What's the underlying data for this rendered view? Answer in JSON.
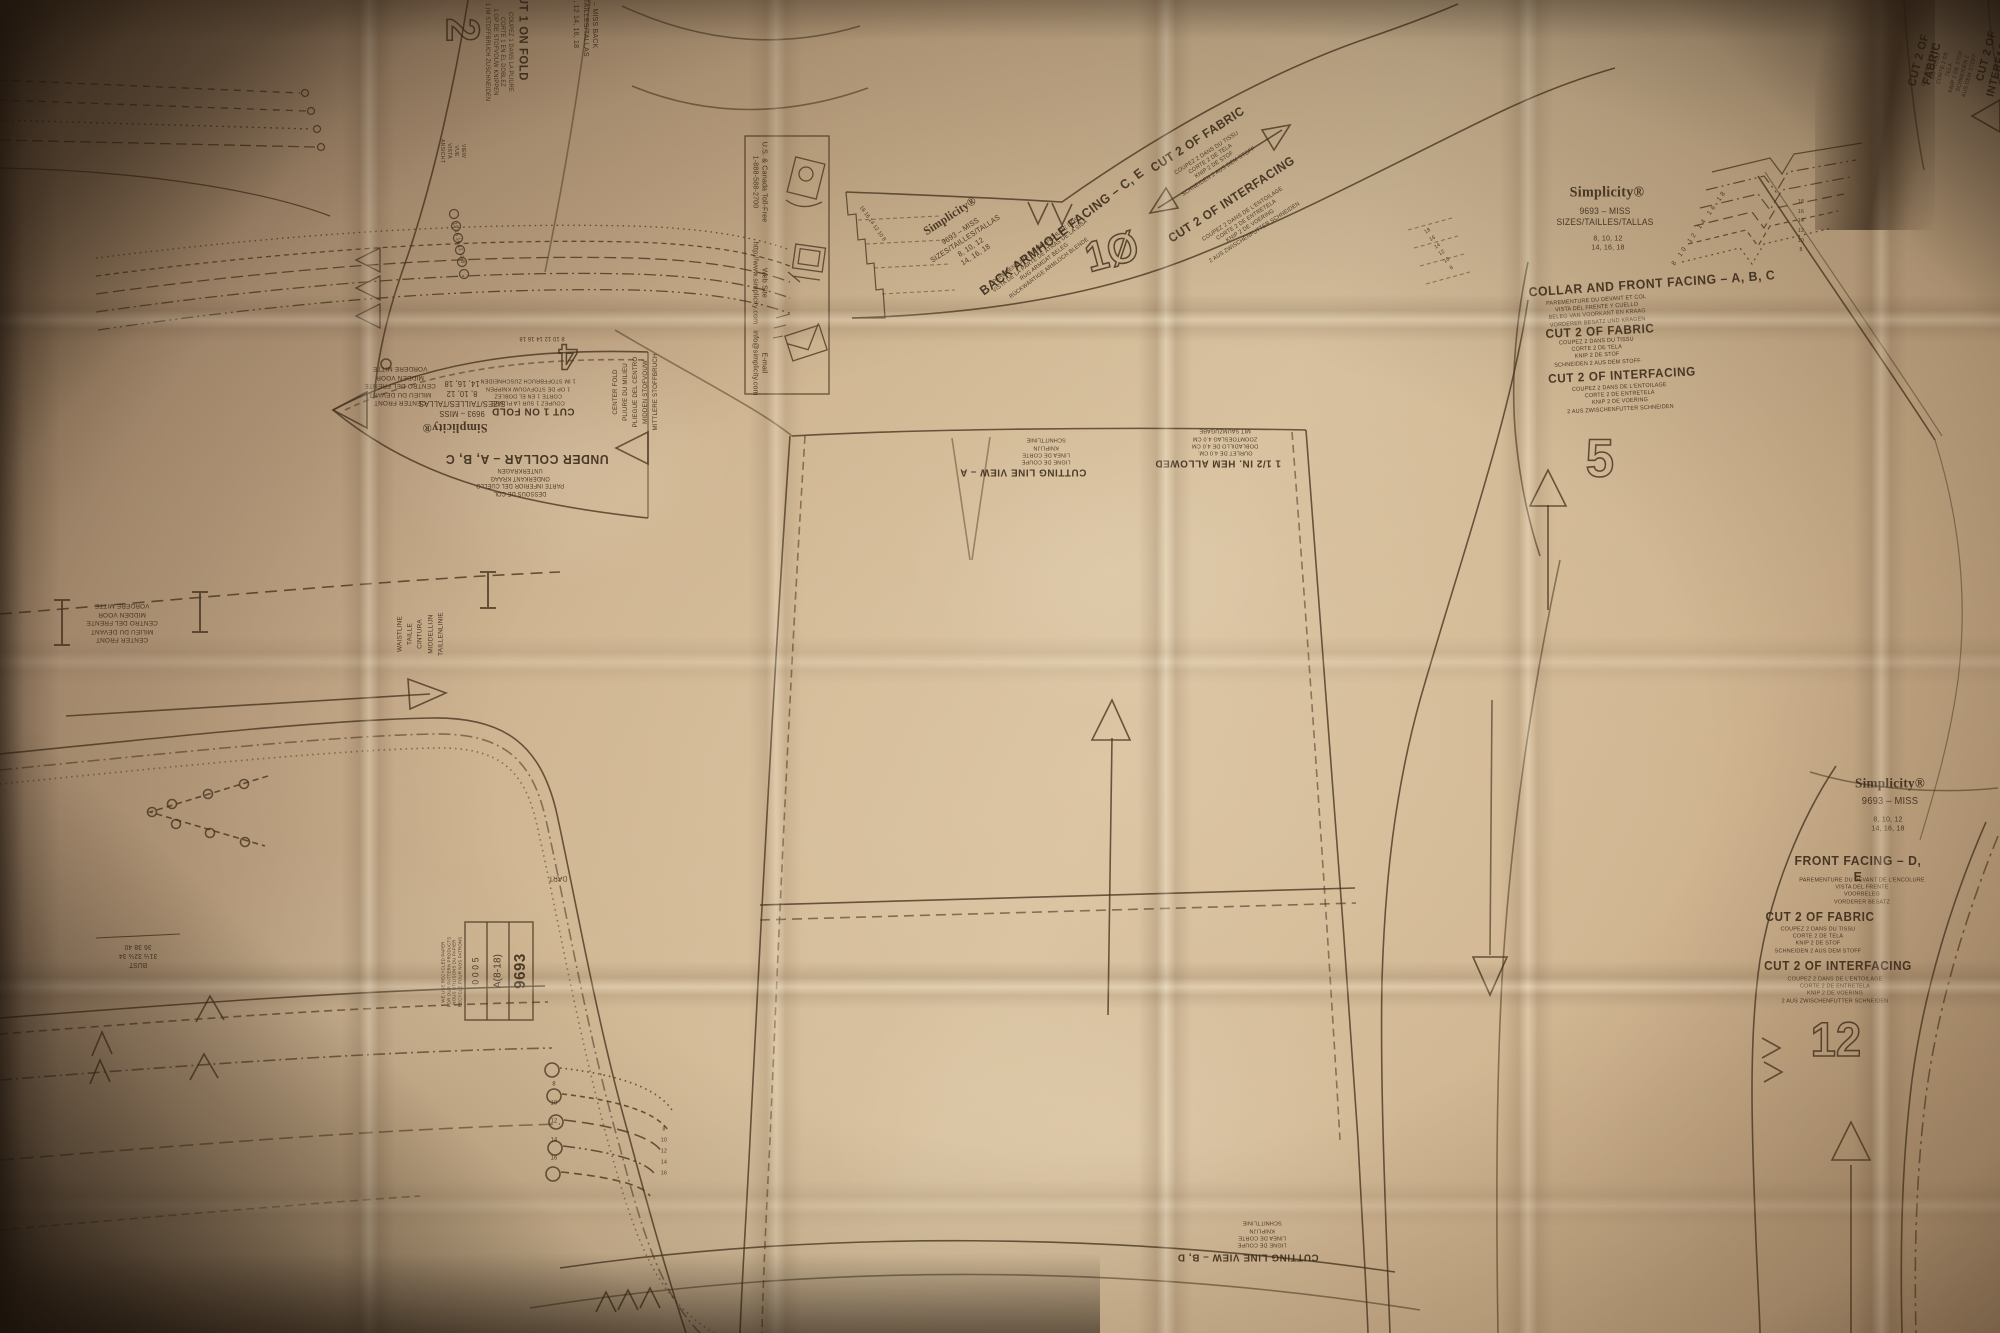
{
  "photo": {
    "subject": "Simplicity 9693 sewing pattern tissue sheet",
    "brand": "Simplicity",
    "pattern_number": "9693",
    "size_range": "A(8-18)",
    "colors": {
      "paper_light": "#d9c3a1",
      "paper_mid": "#c9ae8a",
      "paper_dark": "#8a7054",
      "corner_shadow": "#2e2114",
      "ink": "#3f2f20"
    }
  },
  "icons": [
    {
      "name": "telephone-icon",
      "meaning": "U.S. & Canada toll-free phone"
    },
    {
      "name": "computer-icon",
      "meaning": "web site"
    },
    {
      "name": "envelope-icon",
      "meaning": "e-mail"
    }
  ],
  "labels": [
    {
      "name": "piece2-number",
      "text": "2",
      "x": 462,
      "y": 30,
      "rot": 90,
      "size": 46,
      "hollow": true
    },
    {
      "name": "piece2-cut1-onfold",
      "text": "CUT 1 ON FOLD",
      "x": 523,
      "y": 34,
      "rot": 90,
      "size": 12,
      "bold": true
    },
    {
      "name": "piece2-cut1-onfold-sub",
      "text": "COUPEZ 1 DANS LA PLIURE\nCORTE 1 EN EL DOBLEZ\n1 OP DE STOFVOUW KNIPPEN\n1 IM STOFFBRUCH ZUSCHNEIDEN",
      "x": 498,
      "y": 52,
      "rot": 90,
      "size": 6
    },
    {
      "name": "piece2-info-block",
      "text": "9693 – MISS   BACK\nSIZES/TAILLES/TALLAS\n8, 10, 12   14, 16, 18",
      "x": 586,
      "y": 16,
      "rot": 90,
      "size": 7.5
    },
    {
      "name": "piece2-views",
      "text": "VIEW\nVUE\nVISTA\nANSICHT",
      "x": 452,
      "y": 151,
      "rot": 90,
      "size": 5.5
    },
    {
      "name": "infobox-phone-label",
      "text": "U.S. & Canada Toll-Free\n1-888-588-2700",
      "x": 760,
      "y": 182,
      "rot": 90,
      "size": 7.5
    },
    {
      "name": "infobox-web-label",
      "text": "Web Site\nhttp://www.simplicity.com",
      "x": 760,
      "y": 283,
      "rot": 90,
      "size": 7.5
    },
    {
      "name": "infobox-email-label",
      "text": "E-mail\ninfo@simplicity.com",
      "x": 760,
      "y": 363,
      "rot": 90,
      "size": 7.5
    },
    {
      "name": "collar-sizes-column",
      "text": "18 16 14 12 10 8",
      "x": 458,
      "y": 243,
      "rot": 78,
      "size": 5.5
    },
    {
      "name": "undercollar-title",
      "text": "UNDER COLLAR – A, B, C",
      "x": 527,
      "y": 459,
      "rot": 180,
      "size": 13,
      "bold": true
    },
    {
      "name": "undercollar-title-sub",
      "text": "DESSOUS DE COL\nPARTE INFERIOR DEL CUELLO\nONDERKANT KRAAG\nUNTERKRAGEN",
      "x": 520,
      "y": 481,
      "rot": 180,
      "size": 6
    },
    {
      "name": "undercollar-brand-logo",
      "text": "Simplicity®",
      "x": 455,
      "y": 428,
      "rot": 180,
      "size": 13,
      "brand": true
    },
    {
      "name": "undercollar-brand-info",
      "text": "9693 – MISS\nSIZES/TAILLES/TALLAS\n8, 10, 12\n14, 16, 18",
      "x": 462,
      "y": 398,
      "rot": 180,
      "size": 8
    },
    {
      "name": "undercollar-cut1-onfold",
      "text": "CUT 1 ON FOLD",
      "x": 533,
      "y": 411,
      "rot": 180,
      "size": 10.5,
      "bold": true
    },
    {
      "name": "undercollar-cut1-onfold-sub",
      "text": "COUPEZ 1 SUR LA PLIURE\nCORTE 1 EN EL DOBLEZ\n1 OP DE STOFVOUW KNIPPEN\n1 IM STOFFBRUCH ZUSCHNEIDEN",
      "x": 528,
      "y": 391,
      "rot": 180,
      "size": 5.8
    },
    {
      "name": "undercollar-centerfront",
      "text": "CENTER FRONT\nMILIEU DU DEVANT\nCENTRO DEL FRENTE\nMIDDEN VOOR\nVORDERE MITTE",
      "x": 400,
      "y": 385,
      "rot": 180,
      "size": 6.8
    },
    {
      "name": "undercollar-centerfold",
      "text": "CENTER FOLD\nPLIURE DU MILIEU\nPLIEGUE DEL CENTRO\nMIDDEN STOFVOUW\nMITTLERE STOFFBRUCH",
      "x": 636,
      "y": 392,
      "rot": -90,
      "size": 6.5,
      "lh": 1.55
    },
    {
      "name": "undercollar-number",
      "text": "4",
      "x": 568,
      "y": 357,
      "rot": 180,
      "size": 36,
      "hollow": true
    },
    {
      "name": "undercollar-sizes-cluster",
      "text": "8 10 12 14 16 18",
      "x": 542,
      "y": 337,
      "rot": 180,
      "size": 6
    },
    {
      "name": "armfacing-brand-logo",
      "text": "Simplicity®",
      "x": 950,
      "y": 216,
      "rot": -33,
      "size": 12,
      "brand": true
    },
    {
      "name": "armfacing-brand-info",
      "text": "9693 – MISS\nSIZES/TAILLES/TALLAS\n8, 10, 12\n14, 16, 18",
      "x": 968,
      "y": 243,
      "rot": -33,
      "size": 7.5
    },
    {
      "name": "armfacing-title",
      "text": "BACK ARMHOLE FACING – C, E",
      "x": 1062,
      "y": 232,
      "rot": -37,
      "size": 13,
      "bold": true
    },
    {
      "name": "armfacing-title-sub",
      "text": "PAREMENTURE D'EMMANCHURE DOS\nVISTA DE LA PARTE DE ATRAS DE LA SISA\nRUG ARMGAT BELEG\nRÜCKWÄRTIGE ARMLOCH BLENDE",
      "x": 1043,
      "y": 260,
      "rot": -37,
      "size": 5.8
    },
    {
      "name": "armfacing-number",
      "text": "1Ø",
      "x": 1112,
      "y": 252,
      "rot": -15,
      "size": 42,
      "hollow": true
    },
    {
      "name": "armfacing-cut2-fabric",
      "text": "CUT 2 OF FABRIC",
      "x": 1198,
      "y": 140,
      "rot": -33,
      "size": 12.5,
      "bold": true
    },
    {
      "name": "armfacing-cut2-fabric-sub",
      "text": "COUPEZ 2 DANS DU TISSU\nCORTE 2 DE TELA\nKNIP 2 DE STOF\nSCHNEIDEN 2 AUS DEM STOFF",
      "x": 1213,
      "y": 163,
      "rot": -33,
      "size": 5.8
    },
    {
      "name": "armfacing-cut2-interfacing",
      "text": "CUT 2 OF INTERFACING",
      "x": 1232,
      "y": 200,
      "rot": -33,
      "size": 12.5,
      "bold": true
    },
    {
      "name": "armfacing-cut2-interfacing-sub",
      "text": "COUPEZ 2 DANS DE L'ENTOILAGE\nCORTE 2 DE ENTRETELA\nKNIP 2 DE VOERING\n2 AUS ZWISCHENFUTTER SCHNEIDEN",
      "x": 1249,
      "y": 224,
      "rot": -33,
      "size": 5.8
    },
    {
      "name": "armfacing-sizes-left",
      "text": "18 16 14 12 10 8",
      "x": 872,
      "y": 224,
      "rot": 55,
      "size": 5.5
    },
    {
      "name": "armfacing-sizes-right",
      "text": "18\n16\n14\n12\n10\n8",
      "x": 1440,
      "y": 250,
      "rot": -33,
      "size": 5.5,
      "lh": 1.6
    },
    {
      "name": "trcorner-cut2-fabric",
      "text": "CUT 2 OF FABRIC",
      "x": 1926,
      "y": 62,
      "rot": -75,
      "size": 11.5,
      "bold": true
    },
    {
      "name": "trcorner-cut2-fabric-sub",
      "text": "COUPEZ 2 DANS DU TISSU\nCORTE 2 DE TELA\nKNIP 2 DE STOF\nSCHNEIDEN 2 AUS DEM STOFF",
      "x": 1950,
      "y": 70,
      "rot": -75,
      "size": 5.6
    },
    {
      "name": "trcorner-cut2-interfacing",
      "text": "CUT 2 OF INTERFACING",
      "x": 1994,
      "y": 58,
      "rot": -75,
      "size": 11,
      "bold": true
    },
    {
      "name": "facing5-brand-logo",
      "text": "Simplicity®",
      "x": 1607,
      "y": 193,
      "rot": 0,
      "size": 15,
      "brand": true
    },
    {
      "name": "facing5-brand-info",
      "text": "9693 – MISS\nSIZES/TAILLES/TALLAS",
      "x": 1605,
      "y": 217,
      "rot": 0,
      "size": 9
    },
    {
      "name": "facing5-brand-sizes",
      "text": "8, 10, 12\n14, 16, 18",
      "x": 1608,
      "y": 243,
      "rot": 0,
      "size": 7.5
    },
    {
      "name": "facing5-sizes-arc",
      "text": "8 10 12 14 16 18",
      "x": 1700,
      "y": 228,
      "rot": -55,
      "size": 6.5,
      "ls": 3
    },
    {
      "name": "facing5-title",
      "text": "COLLAR AND FRONT FACING – A, B, C",
      "x": 1652,
      "y": 284,
      "rot": -4,
      "size": 13,
      "bold": true
    },
    {
      "name": "facing5-title-sub",
      "text": "PAREMENTURE DU DEVANT ET COL\nVISTA DEL FRENTE Y CUELLO\nBELEG VAN VOORKANT EN KRAAG\nVORDERER BESATZ UND KRAGEN",
      "x": 1597,
      "y": 312,
      "rot": -4,
      "size": 5.8
    },
    {
      "name": "facing5-cut2-fabric",
      "text": "CUT 2 OF FABRIC",
      "x": 1600,
      "y": 332,
      "rot": -3,
      "size": 12.5,
      "bold": true
    },
    {
      "name": "facing5-cut2-fabric-sub",
      "text": "COUPEZ 2 DANS DU TISSU\nCORTE 2 DE TELA\nKNIP 2 DE STOF\nSCHNEIDEN 2 AUS DEM STOFF",
      "x": 1597,
      "y": 353,
      "rot": -3,
      "size": 5.8
    },
    {
      "name": "facing5-cut2-interfacing",
      "text": "CUT 2 OF INTERFACING",
      "x": 1622,
      "y": 376,
      "rot": -3,
      "size": 12.5,
      "bold": true
    },
    {
      "name": "facing5-cut2-interfacing-sub",
      "text": "COUPEZ 2 DANS DE L'ENTOILAGE\nCORTE 2 DE ENTRETELA\nKNIP 2 DE VOERING\n2 AUS ZWISCHENFUTTER SCHNEIDEN",
      "x": 1620,
      "y": 399,
      "rot": -3,
      "size": 5.8
    },
    {
      "name": "facing5-number",
      "text": "5",
      "x": 1600,
      "y": 459,
      "rot": 0,
      "size": 54,
      "hollow": true
    },
    {
      "name": "facing5-sizes-right",
      "text": "18\n16\n14\n12\n10\n8",
      "x": 1801,
      "y": 227,
      "rot": 0,
      "size": 5.5,
      "lh": 1.75
    },
    {
      "name": "facingDE-brand-logo",
      "text": "Simplicity®",
      "x": 1890,
      "y": 784,
      "rot": 0,
      "size": 14,
      "brand": true
    },
    {
      "name": "facingDE-brand-info",
      "text": "9693 – MISS",
      "x": 1890,
      "y": 802,
      "rot": 0,
      "size": 10
    },
    {
      "name": "facingDE-brand-sizes",
      "text": "8, 10, 12\n14, 16, 18",
      "x": 1888,
      "y": 824,
      "rot": 0,
      "size": 7.5
    },
    {
      "name": "facingDE-title",
      "text": "FRONT FACING – D, E",
      "x": 1858,
      "y": 869,
      "rot": 0,
      "size": 13,
      "bold": true
    },
    {
      "name": "facingDE-title-sub",
      "text": "PAREMENTURE DU DEVANT DE L'ENCOLURE\nVISTA DEL FRENTE\nVOORBELEG\nVORDERER BESATZ",
      "x": 1862,
      "y": 892,
      "rot": 0,
      "size": 5.8
    },
    {
      "name": "facingDE-cut2-fabric",
      "text": "CUT 2 OF FABRIC",
      "x": 1820,
      "y": 918,
      "rot": 0,
      "size": 12.5,
      "bold": true
    },
    {
      "name": "facingDE-cut2-fabric-sub",
      "text": "COUPEZ 2 DANS DU TISSU\nCORTE 2 DE TELA\nKNIP 2 DE STOF\nSCHNEIDEN 2 AUS DEM STOFF",
      "x": 1818,
      "y": 941,
      "rot": 0,
      "size": 5.8
    },
    {
      "name": "facingDE-cut2-interfacing",
      "text": "CUT 2 OF INTERFACING",
      "x": 1838,
      "y": 967,
      "rot": 0,
      "size": 12.5,
      "bold": true
    },
    {
      "name": "facingDE-cut2-interfacing-sub",
      "text": "COUPEZ 2 DANS DE L'ENTOILAGE\nCORTE 2 DE ENTRETELA\nKNIP 2 DE VOERING\n2 AUS ZWISCHENFUTTER SCHNEIDEN",
      "x": 1835,
      "y": 991,
      "rot": 0,
      "size": 5.8
    },
    {
      "name": "facingDE-number",
      "text": "12",
      "x": 1836,
      "y": 1041,
      "rot": 0,
      "size": 48,
      "hollow": true
    },
    {
      "name": "skirtA-cuttingline",
      "text": "CUTTING LINE VIEW – A",
      "x": 1023,
      "y": 472,
      "rot": 180,
      "size": 10.5,
      "bold": true
    },
    {
      "name": "skirtA-cuttingline-sub",
      "text": "LIGNE DE COUPE\nLINEA DE CORTE\nKNIPLIJN\nSCHNITTLINIE",
      "x": 1046,
      "y": 450,
      "rot": 180,
      "size": 5.8
    },
    {
      "name": "skirtA-hem-allowance",
      "text": "1 1/2 IN. HEM ALLOWED",
      "x": 1218,
      "y": 463,
      "rot": 180,
      "size": 10.5,
      "bold": true
    },
    {
      "name": "skirtA-hem-allowance-sub",
      "text": "OURLET DE 4.0 CM.\nDOBLADILLO DE 4.0 CM\nZOOMTOESLAG 4.0 CM\nMIT SAUMZUGABE",
      "x": 1225,
      "y": 441,
      "rot": 180,
      "size": 5.8
    },
    {
      "name": "skirtBD-cuttingline",
      "text": "CUTTING LINE VIEW – B, D",
      "x": 1248,
      "y": 1257,
      "rot": 180,
      "size": 10.5,
      "bold": true
    },
    {
      "name": "skirtBD-cuttingline-sub",
      "text": "LIGNE DE COUPE\nLINEA DE CORTE\nKNIPLIJN\nSCHNITTLINIE",
      "x": 1262,
      "y": 1233,
      "rot": 180,
      "size": 5.8
    },
    {
      "name": "leftpiece-centerfront",
      "text": "CENTER FRONT\nMILIEU DU DEVANT\nCENTRO DEL FRENTE\nMIDDEN VOOR\nVORDERE MITTE",
      "x": 122,
      "y": 622,
      "rot": 180,
      "size": 6.8
    },
    {
      "name": "leftpiece-waistline",
      "text": "WAISTLINE\nTAILLE\nCINTURA\nMIDDELLIJN\nTAILLENLINIE",
      "x": 421,
      "y": 634,
      "rot": -90,
      "size": 6.8,
      "lh": 1.5
    },
    {
      "name": "leftpiece-bust-table",
      "text": "BUST\n31½  32½  34\n36   38   40",
      "x": 138,
      "y": 955,
      "rot": 180,
      "size": 7
    },
    {
      "name": "leftpiece-dart-label",
      "text": "DART",
      "x": 558,
      "y": 877,
      "rot": 180,
      "size": 7
    },
    {
      "name": "leftpiece-fold-sizes-circles",
      "text": "8\n10\n12\n14\n16",
      "x": 554,
      "y": 1122,
      "rot": 0,
      "size": 6,
      "lh": 3.1
    },
    {
      "name": "leftpiece-fold-sizes-bend",
      "text": "8\n10\n12\n14\n16",
      "x": 664,
      "y": 1152,
      "rot": 0,
      "size": 5.5,
      "lh": 2.0
    },
    {
      "name": "pattern-number-box-number",
      "text": "9693",
      "x": 521,
      "y": 971,
      "rot": -90,
      "size": 16,
      "bold": true
    },
    {
      "name": "pattern-number-box-size",
      "text": "A(8-18)",
      "x": 498,
      "y": 971,
      "rot": -90,
      "size": 10.5
    },
    {
      "name": "pattern-number-box-codes",
      "text": "0 0 0 5",
      "x": 476,
      "y": 971,
      "rot": -90,
      "size": 9
    },
    {
      "name": "recycled-paper-note",
      "text": "WE USE RECYCLED PAPER\nFOR OUR PATTERN PRODUCTS\nNOUS UTILISONS DU PAPIER\nRECYCLE POUR NOS PATRONS",
      "x": 452,
      "y": 972,
      "rot": -90,
      "size": 4.6
    }
  ]
}
